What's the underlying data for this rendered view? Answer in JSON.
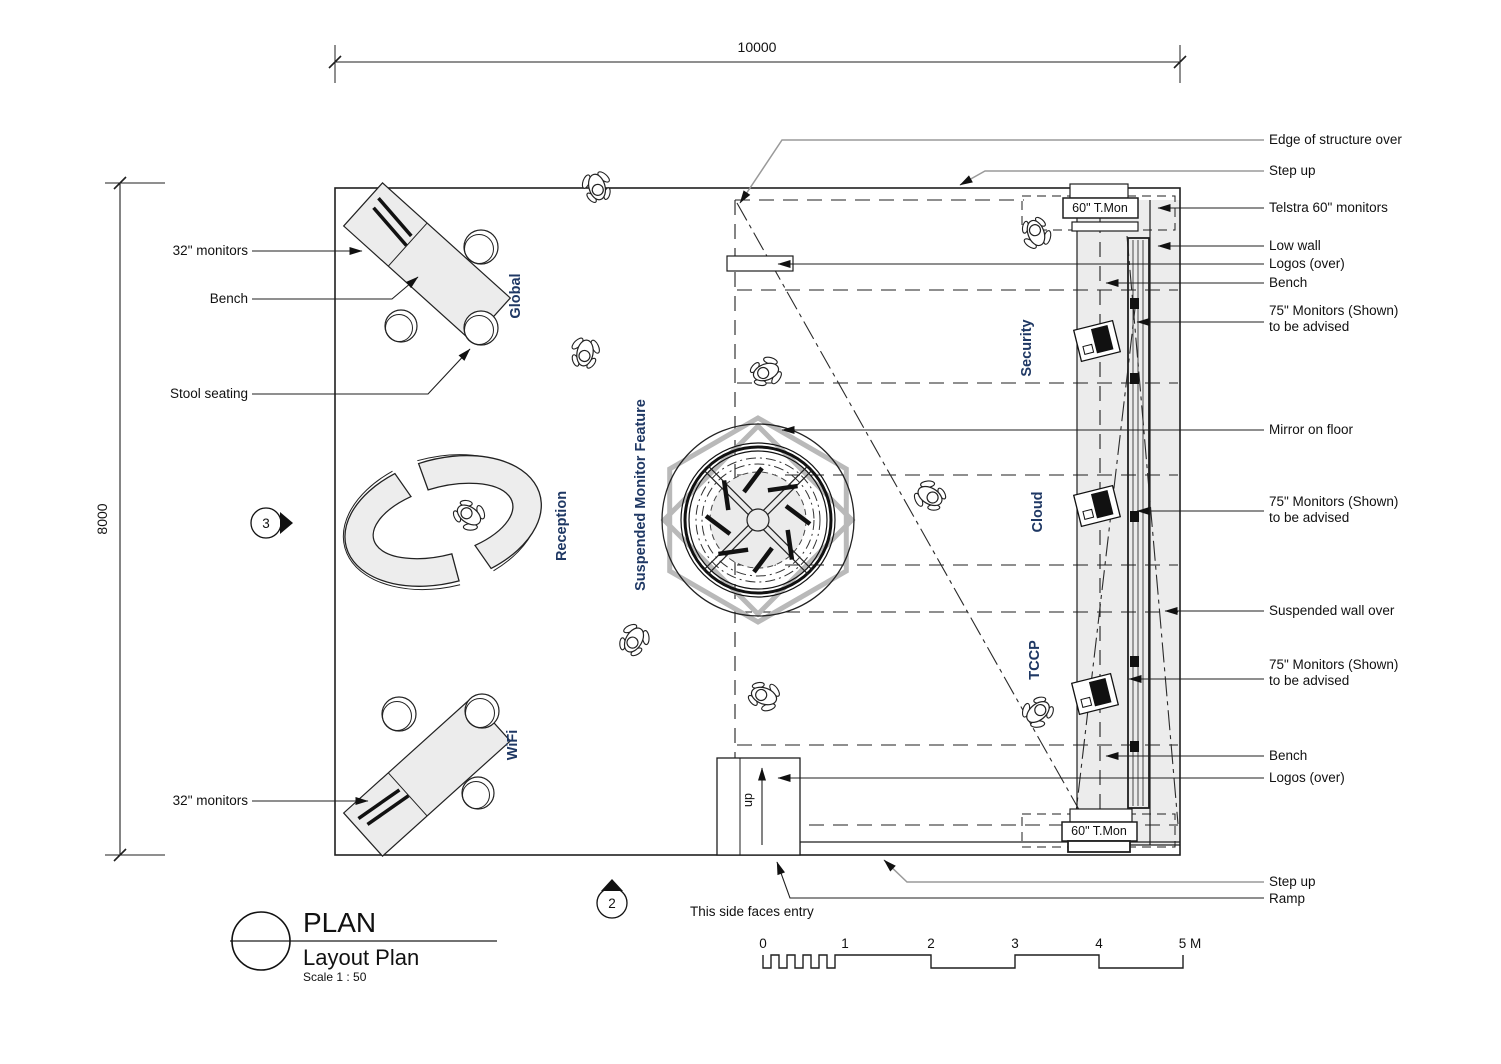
{
  "drawing": {
    "title": "PLAN",
    "subtitle": "Layout Plan",
    "scale_note": "Scale  1 : 50",
    "dim_width": "10000",
    "dim_height": "8000",
    "marker_left": "3",
    "marker_bottom": "2",
    "entry_note": "This side faces entry",
    "ramp_direction": "up",
    "tmon_top": "60\" T.Mon",
    "tmon_bottom": "60\" T.Mon"
  },
  "zones": {
    "global": "Global",
    "reception": "Reception",
    "suspended_monitor_feature": "Suspended Monitor Feature",
    "wifi": "WiFi",
    "security": "Security",
    "cloud": "Cloud",
    "tccp": "TCCP"
  },
  "labels_left": {
    "monitors_top": "32\" monitors",
    "bench": "Bench",
    "stool_seating": "Stool seating",
    "monitors_bottom": "32\" monitors"
  },
  "labels_right": {
    "edge_of_structure": "Edge of structure over",
    "step_up_top": "Step up",
    "telstra_monitors": "Telstra 60\" monitors",
    "low_wall": "Low wall",
    "logos_top": "Logos (over)",
    "bench_top": "Bench",
    "m75_1_l1": "75\" Monitors (Shown)",
    "m75_1_l2": "to be advised",
    "mirror_on_floor": "Mirror on floor",
    "m75_2_l1": "75\" Monitors (Shown)",
    "m75_2_l2": "to be advised",
    "suspended_wall": "Suspended wall over",
    "m75_3_l1": "75\" Monitors (Shown)",
    "m75_3_l2": "to be advised",
    "bench_bottom": "Bench",
    "logos_bottom": "Logos (over)",
    "step_up_bottom": "Step up",
    "ramp": "Ramp"
  },
  "scale_bar": {
    "t0": "0",
    "t1": "1",
    "t2": "2",
    "t3": "3",
    "t4": "4",
    "t5": "5 M"
  },
  "colors": {
    "line": "#1f1f1f",
    "gray_leader": "#9a9a9a",
    "light_fill": "#ececec",
    "feature_gray": "#b9b9b9",
    "zone_text": "#1f3864"
  }
}
